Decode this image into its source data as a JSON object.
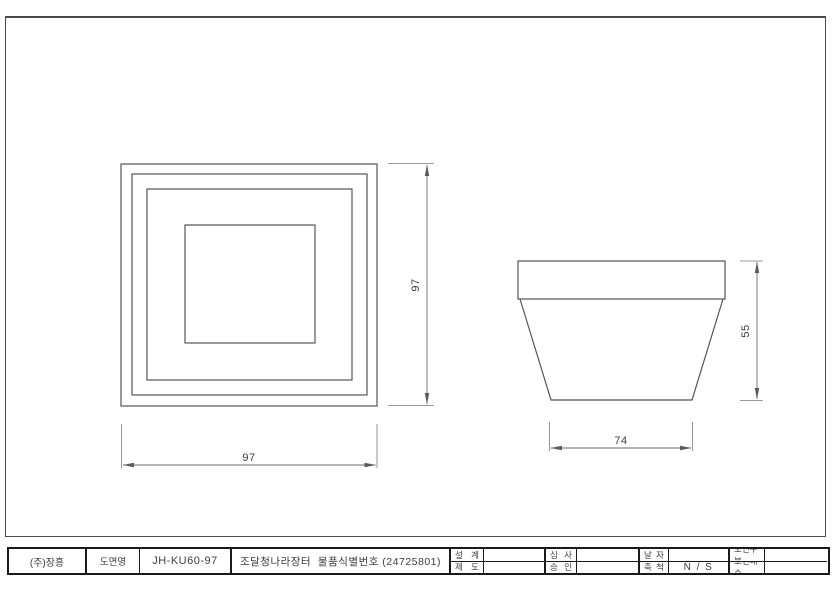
{
  "drawing": {
    "plan_view": {
      "width_dim": "97",
      "height_dim": "97"
    },
    "side_view": {
      "base_width_dim": "74",
      "height_dim": "55"
    }
  },
  "title_block": {
    "company": "(주)장흥",
    "drawing_name_label": "도면명",
    "drawing_code": "JH-KU60-97",
    "drawing_title": "조달청나라장터  물품식별번호 (24725801)",
    "design_label": "설 계",
    "draft_label": "제 도",
    "review_label": "심 사",
    "approve_label": "승 인",
    "date_label": "날 자",
    "scale_label": "축 척",
    "scale_value": "N / S",
    "sheet_class_label": "도면구분",
    "sheet_count_label": "도면매수"
  },
  "colors": {
    "object_line": "#555555",
    "dimension_line": "#6a6a6a",
    "frame_line": "#4a4a4a",
    "table_line": "#1a1a1a"
  }
}
